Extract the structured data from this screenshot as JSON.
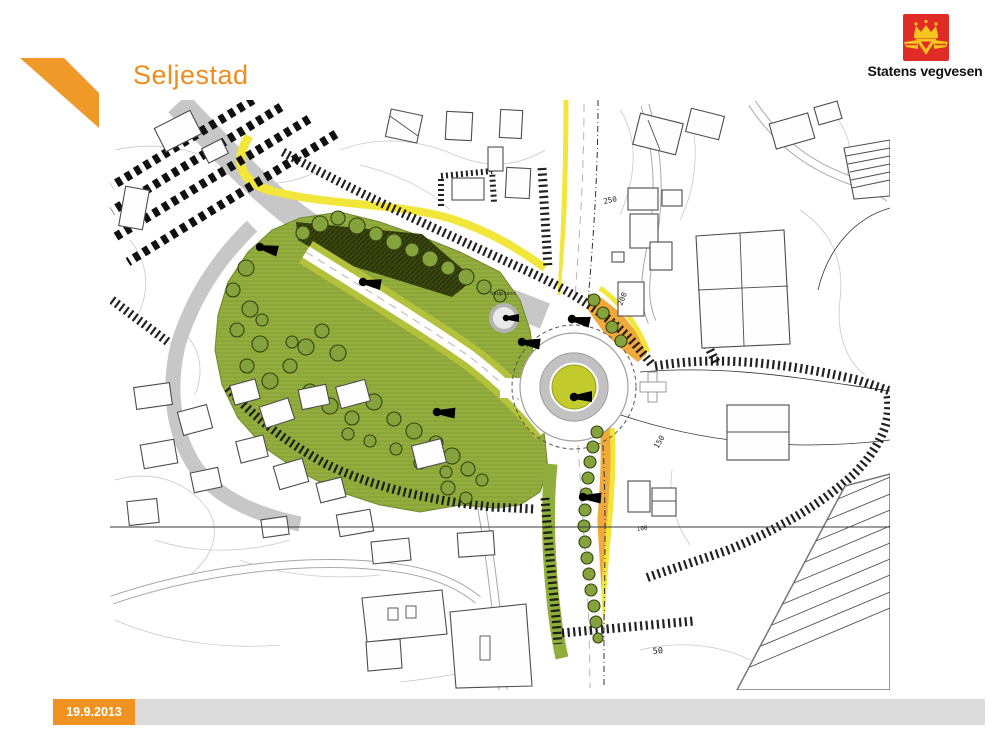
{
  "slide": {
    "title": "Seljestad",
    "footer_date": "19.9.2013"
  },
  "logo": {
    "text": "Statens vegvesen"
  },
  "map_labels": {
    "snuplass": "Snuplass",
    "c50": "50",
    "c100": "100",
    "c150": "150",
    "c200": "200",
    "c250": "250"
  },
  "colors": {
    "accent_orange": "#ef9a28",
    "title_orange": "#ee8d1d",
    "footer_gray": "#dcdcdc",
    "logo_red": "#e02b26",
    "logo_gold": "#f6c51e",
    "park_green": "#9ab141",
    "island_green": "#c3ca2c",
    "slope_orange": "#f2a93c",
    "highlight_yellow": "#f1e639"
  }
}
